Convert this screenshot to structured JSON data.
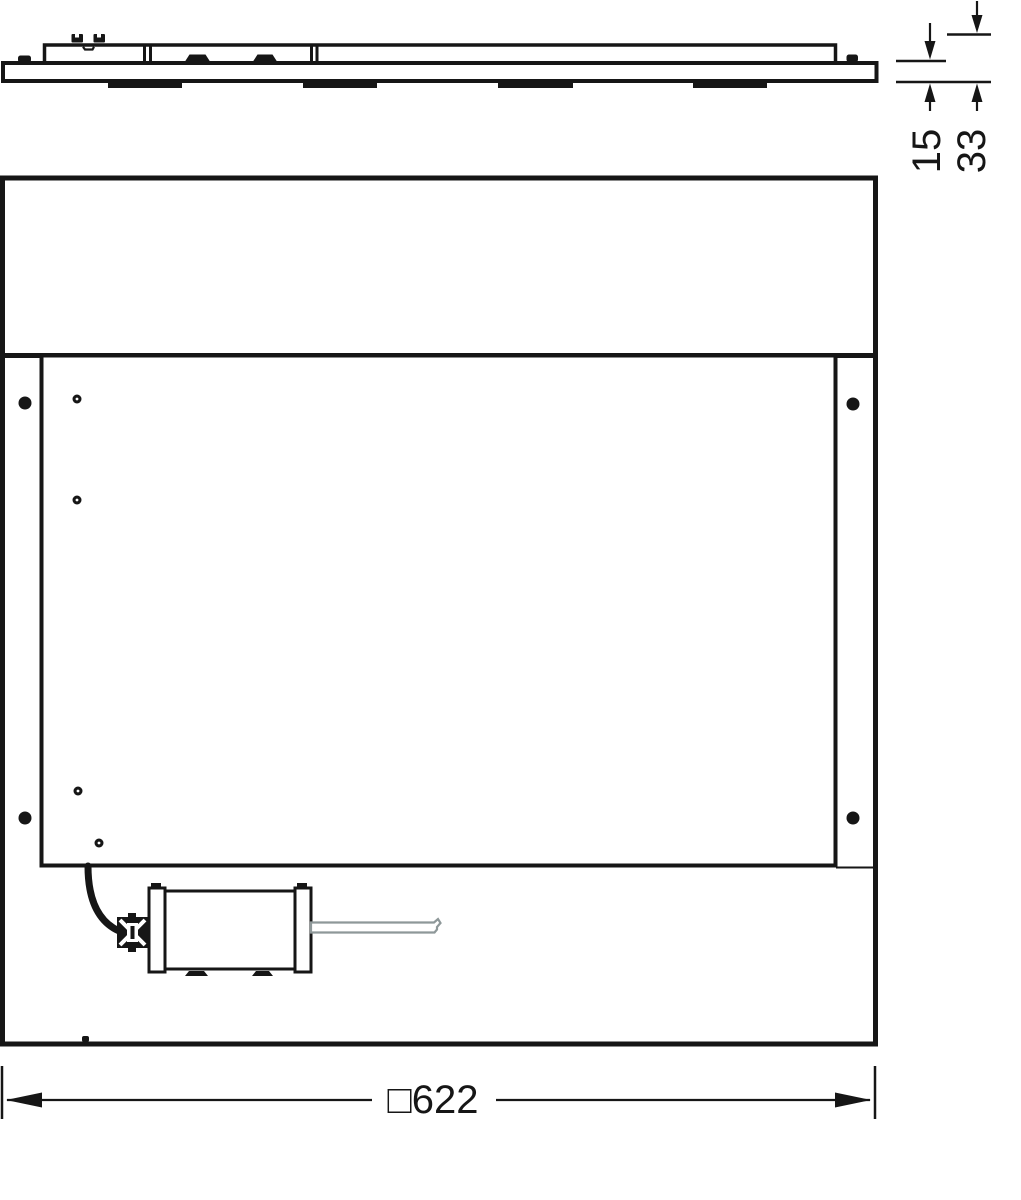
{
  "dimensions": {
    "panel_height": "15",
    "total_height": "33",
    "width": "□622"
  },
  "colors": {
    "line": "#161616",
    "wire": "#8e9899"
  }
}
